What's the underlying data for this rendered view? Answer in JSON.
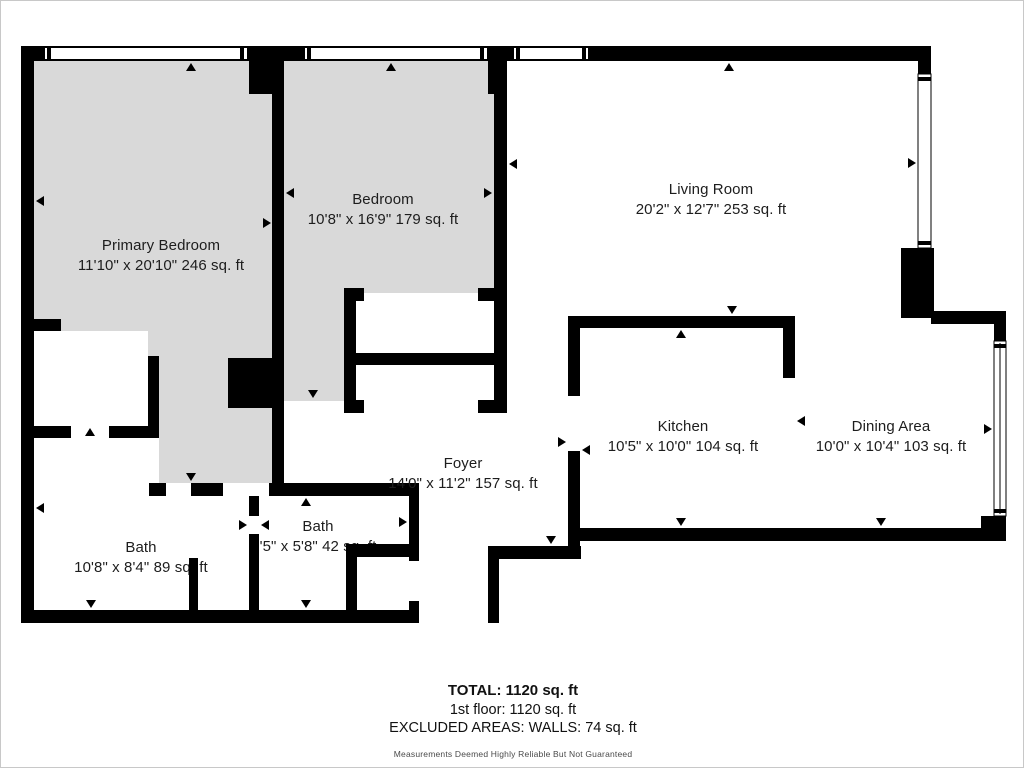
{
  "floorplan": {
    "rooms": [
      {
        "id": "primary-bedroom",
        "name": "Primary Bedroom",
        "dims": "11'10\" x 20'10\" 246 sq. ft"
      },
      {
        "id": "bedroom",
        "name": "Bedroom",
        "dims": "10'8\" x 16'9\" 179 sq. ft"
      },
      {
        "id": "living-room",
        "name": "Living Room",
        "dims": "20'2\" x 12'7\" 253 sq. ft"
      },
      {
        "id": "kitchen",
        "name": "Kitchen",
        "dims": "10'5\" x 10'0\" 104 sq. ft"
      },
      {
        "id": "dining-area",
        "name": "Dining Area",
        "dims": "10'0\" x 10'4\" 103 sq. ft"
      },
      {
        "id": "foyer",
        "name": "Foyer",
        "dims": "14'0\" x 11'2\" 157 sq. ft"
      },
      {
        "id": "bath-1",
        "name": "Bath",
        "dims": "10'8\" x 8'4\" 89 sq. ft"
      },
      {
        "id": "bath-2",
        "name": "Bath",
        "dims": "'5\" x 5'8\" 42 sq. ft"
      }
    ],
    "summary": {
      "total": "TOTAL: 1120 sq. ft",
      "floor": "1st floor: 1120 sq. ft",
      "excluded": "EXCLUDED AREAS: WALLS: 74 sq. ft",
      "disclaimer": "Measurements Deemed Highly Reliable But Not Guaranteed"
    },
    "colors": {
      "wall": "#000000",
      "bedroom_fill": "#d9d9d9",
      "room_fill": "#ffffff"
    }
  }
}
